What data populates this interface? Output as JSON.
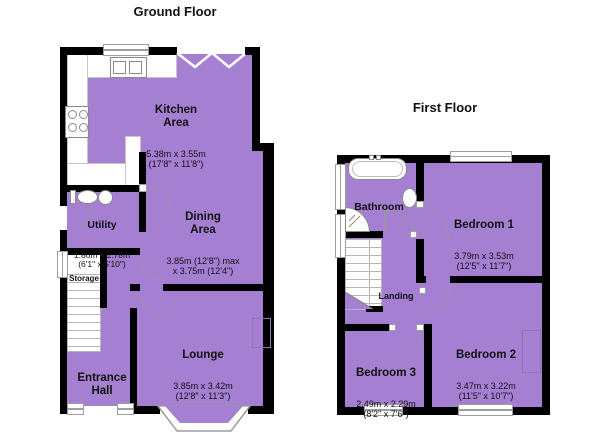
{
  "page": {
    "background": "#ffffff"
  },
  "colors": {
    "floor_fill": "#a57fd2",
    "wall": "#000000",
    "fixture_outline": "#8a8a8a",
    "window_outline": "#9e9e9e"
  },
  "ground_floor": {
    "title": "Ground Floor",
    "rooms": [
      {
        "id": "kitchen",
        "name": "Kitchen\nArea",
        "dims": "5.38m x 3.55m\n(17'8\" x 11'8\")"
      },
      {
        "id": "dining",
        "name": "Dining\nArea",
        "dims": "3.85m (12'8\") max\nx 3.75m (12'4\")"
      },
      {
        "id": "utility",
        "name": "Utility",
        "dims": "1.86m x 1.78m\n(6'1\" x 5'10\")"
      },
      {
        "id": "storage",
        "name": "Storage"
      },
      {
        "id": "entrance-hall",
        "name": "Entrance\nHall"
      },
      {
        "id": "lounge",
        "name": "Lounge",
        "dims": "3.85m x 3.42m\n(12'8\" x 11'3\")"
      }
    ],
    "fixtures": [
      "kitchen-sink",
      "stove-hob",
      "worktop-counter",
      "toilet",
      "utility-sink",
      "staircase",
      "bay-window",
      "open-plan-zigzag"
    ]
  },
  "first_floor": {
    "title": "First Floor",
    "rooms": [
      {
        "id": "bathroom",
        "name": "Bathroom"
      },
      {
        "id": "bedroom-1",
        "name": "Bedroom 1",
        "dims": "3.79m x 3.53m\n(12'5\" x 11'7\")"
      },
      {
        "id": "landing",
        "name": "Landing"
      },
      {
        "id": "bedroom-2",
        "name": "Bedroom 2",
        "dims": "3.47m x 3.22m\n(11'5\" x 10'7\")"
      },
      {
        "id": "bedroom-3",
        "name": "Bedroom 3",
        "dims": "2.49m x 2.29m\n(8'2\" x 7'6\")"
      }
    ],
    "fixtures": [
      "bathtub",
      "wash-basin",
      "corner-shower",
      "staircase"
    ]
  }
}
